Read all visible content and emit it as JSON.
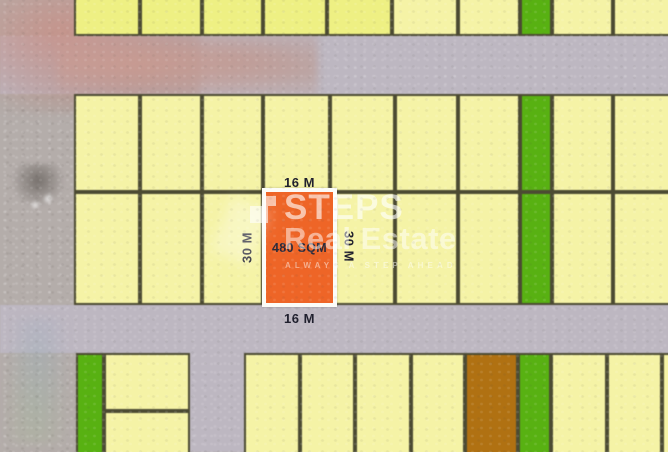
{
  "highlight": {
    "area_label": "480 SQM",
    "top_width_label": "16 M",
    "bottom_width_label": "16 M",
    "left_depth_label": "30 M",
    "right_depth_label": "30 M"
  },
  "watermark": {
    "brand_line1": "STEPS",
    "brand_line2": "Real Estate",
    "tagline": "ALWAYS A STEP AHEAD"
  },
  "colors": {
    "yellow": "#f5f3a6",
    "yellowBright": "#eef083",
    "green": "#58b112",
    "orange": "#ee6527",
    "brown": "#b07112",
    "road": "#bdb7c1",
    "land": "#b4adaa",
    "border": "#4c4b33",
    "label": "#20202e"
  },
  "map": {
    "plots": [
      [
        74,
        -8,
        66,
        44,
        "yellowBright"
      ],
      [
        140,
        -8,
        62,
        44,
        "yellowBright"
      ],
      [
        202,
        -8,
        61,
        44,
        "yellowBright"
      ],
      [
        263,
        -8,
        64,
        44,
        "yellowBright"
      ],
      [
        327,
        -8,
        65,
        44,
        "yellowBright"
      ],
      [
        392,
        -8,
        66,
        44,
        "yellow"
      ],
      [
        458,
        -8,
        62,
        44,
        "yellow"
      ],
      [
        520,
        -8,
        32,
        44,
        "green"
      ],
      [
        552,
        -8,
        61,
        44,
        "yellow"
      ],
      [
        613,
        -8,
        59,
        44,
        "yellow"
      ],
      [
        74,
        94,
        66,
        98,
        "yellow"
      ],
      [
        140,
        94,
        62,
        98,
        "yellow"
      ],
      [
        202,
        94,
        61,
        98,
        "yellow"
      ],
      [
        263,
        94,
        67,
        98,
        "yellow"
      ],
      [
        330,
        94,
        65,
        98,
        "yellow"
      ],
      [
        395,
        94,
        63,
        98,
        "yellow"
      ],
      [
        458,
        94,
        62,
        98,
        "yellow"
      ],
      [
        520,
        94,
        32,
        98,
        "green"
      ],
      [
        552,
        94,
        61,
        98,
        "yellow"
      ],
      [
        613,
        94,
        59,
        98,
        "yellow"
      ],
      [
        74,
        192,
        66,
        113,
        "yellow"
      ],
      [
        140,
        192,
        62,
        113,
        "yellow"
      ],
      [
        202,
        192,
        61,
        113,
        "yellow"
      ],
      [
        263,
        192,
        67,
        113,
        "yellow"
      ],
      [
        330,
        192,
        65,
        113,
        "yellow"
      ],
      [
        395,
        192,
        63,
        113,
        "yellow"
      ],
      [
        458,
        192,
        62,
        113,
        "yellow"
      ],
      [
        520,
        192,
        32,
        113,
        "green"
      ],
      [
        552,
        192,
        61,
        113,
        "yellow"
      ],
      [
        613,
        192,
        59,
        113,
        "yellow"
      ],
      [
        76,
        353,
        28,
        107,
        "green"
      ],
      [
        104,
        353,
        86,
        58,
        "yellow"
      ],
      [
        104,
        411,
        86,
        49,
        "yellow"
      ],
      [
        244,
        353,
        56,
        107,
        "yellow"
      ],
      [
        300,
        353,
        55,
        107,
        "yellow"
      ],
      [
        355,
        353,
        56,
        107,
        "yellow"
      ],
      [
        411,
        353,
        54,
        107,
        "yellow"
      ],
      [
        465,
        353,
        53,
        107,
        "brown"
      ],
      [
        518,
        353,
        33,
        107,
        "green"
      ],
      [
        551,
        353,
        56,
        107,
        "yellow"
      ],
      [
        607,
        353,
        55,
        107,
        "yellow"
      ],
      [
        662,
        353,
        10,
        107,
        "yellow"
      ]
    ]
  }
}
